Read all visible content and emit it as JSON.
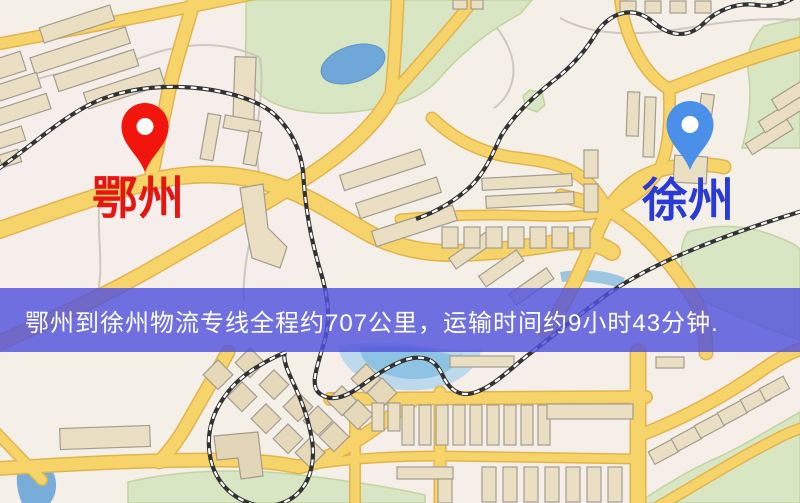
{
  "map": {
    "origin": {
      "label": "鄂州",
      "label_color": "#e81410",
      "pin_color": "#f2150d"
    },
    "destination": {
      "label": "徐州",
      "label_color": "#2a3ad6",
      "pin_color": "#4b90e8"
    },
    "banner": {
      "text": "鄂州到徐州物流专线全程约707公里，运输时间约9小时43分钟.",
      "background_color": "#5252dd",
      "text_color": "#ffffff"
    },
    "palette": {
      "ground": "#f4f0e8",
      "road": "#f7d46a",
      "road_casing": "#e2b44e",
      "building": "#eadfc2",
      "park": "#d9e6c3",
      "water": "#6fa8d8",
      "railway": "#333333"
    }
  }
}
